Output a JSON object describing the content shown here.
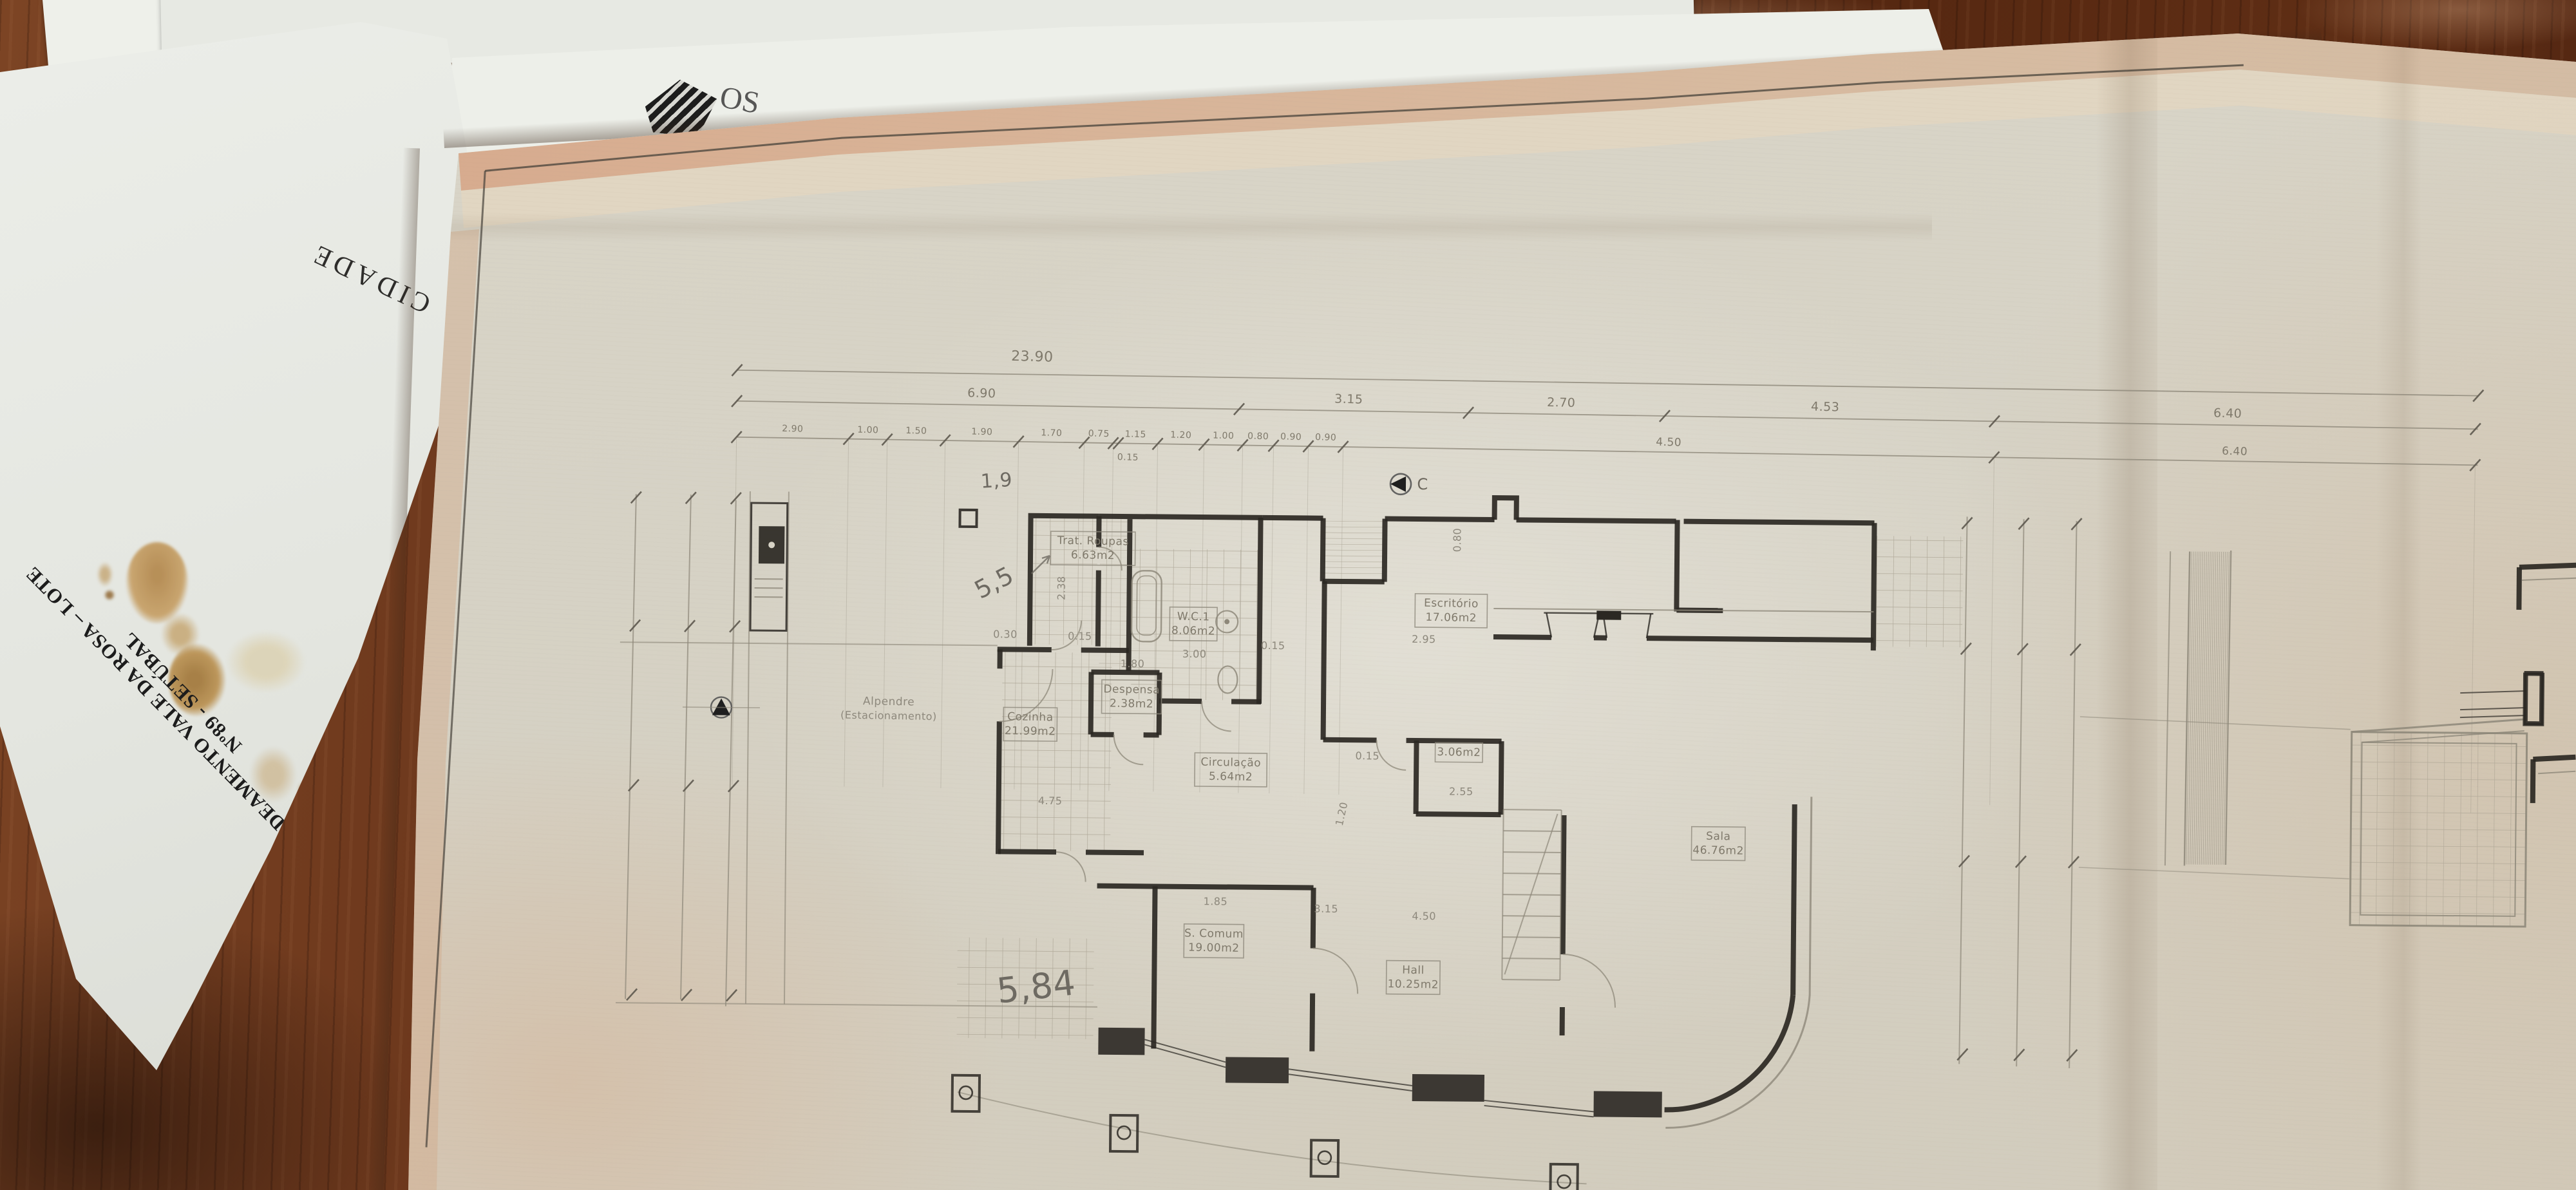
{
  "photo": {
    "underlying_papers": {
      "project_title": "ALDEAMENTO VALE DA ROSA – LOTE Nº89 - SETÚBAL",
      "stamp_word": "CIDADE",
      "letterhead_fragment": "OS"
    },
    "plan": {
      "section_marker": "C",
      "handwritten_notes": [
        "1,9",
        "5,5",
        "5,84"
      ],
      "rooms": [
        {
          "label": "Trat. Roupas",
          "area": "6.63m2"
        },
        {
          "label": "W.C.1",
          "area": "8.06m2"
        },
        {
          "label": "Despensa",
          "area": "2.38m2"
        },
        {
          "label": "Cozinha",
          "area": "21.99m2"
        },
        {
          "label": "Circulação",
          "area": "5.64m2"
        },
        {
          "label": "Escritório",
          "area": "17.06m2"
        },
        {
          "label": "Sala",
          "area": "46.76m2"
        },
        {
          "label": "S. Comum",
          "area": "19.00m2"
        },
        {
          "label": "Hall",
          "area": "10.25m2"
        },
        {
          "label": "",
          "area": "3.06m2"
        },
        {
          "label": "Alpendre",
          "area": "(Estacionamento)"
        }
      ],
      "dimensions": {
        "overall": "23.90",
        "row2": [
          "6.90",
          "3.15",
          "2.70",
          "4.53",
          "6.40"
        ],
        "row3": [
          "2.90",
          "1.00",
          "1.50",
          "1.90",
          "1.70",
          "0.75",
          "1.15",
          "1.20",
          "1.00",
          "0.80",
          "0.90",
          "0.90",
          "4.50",
          "6.40"
        ],
        "row3_sub": "0.15",
        "scattered": [
          "0.30",
          "2.38",
          "0.15",
          "3.00",
          "0.15",
          "1.80",
          "4.75",
          "2.55",
          "1.20",
          "0.15",
          "0.80",
          "2.95",
          "1.85",
          "3.15",
          "4.50"
        ]
      }
    }
  }
}
